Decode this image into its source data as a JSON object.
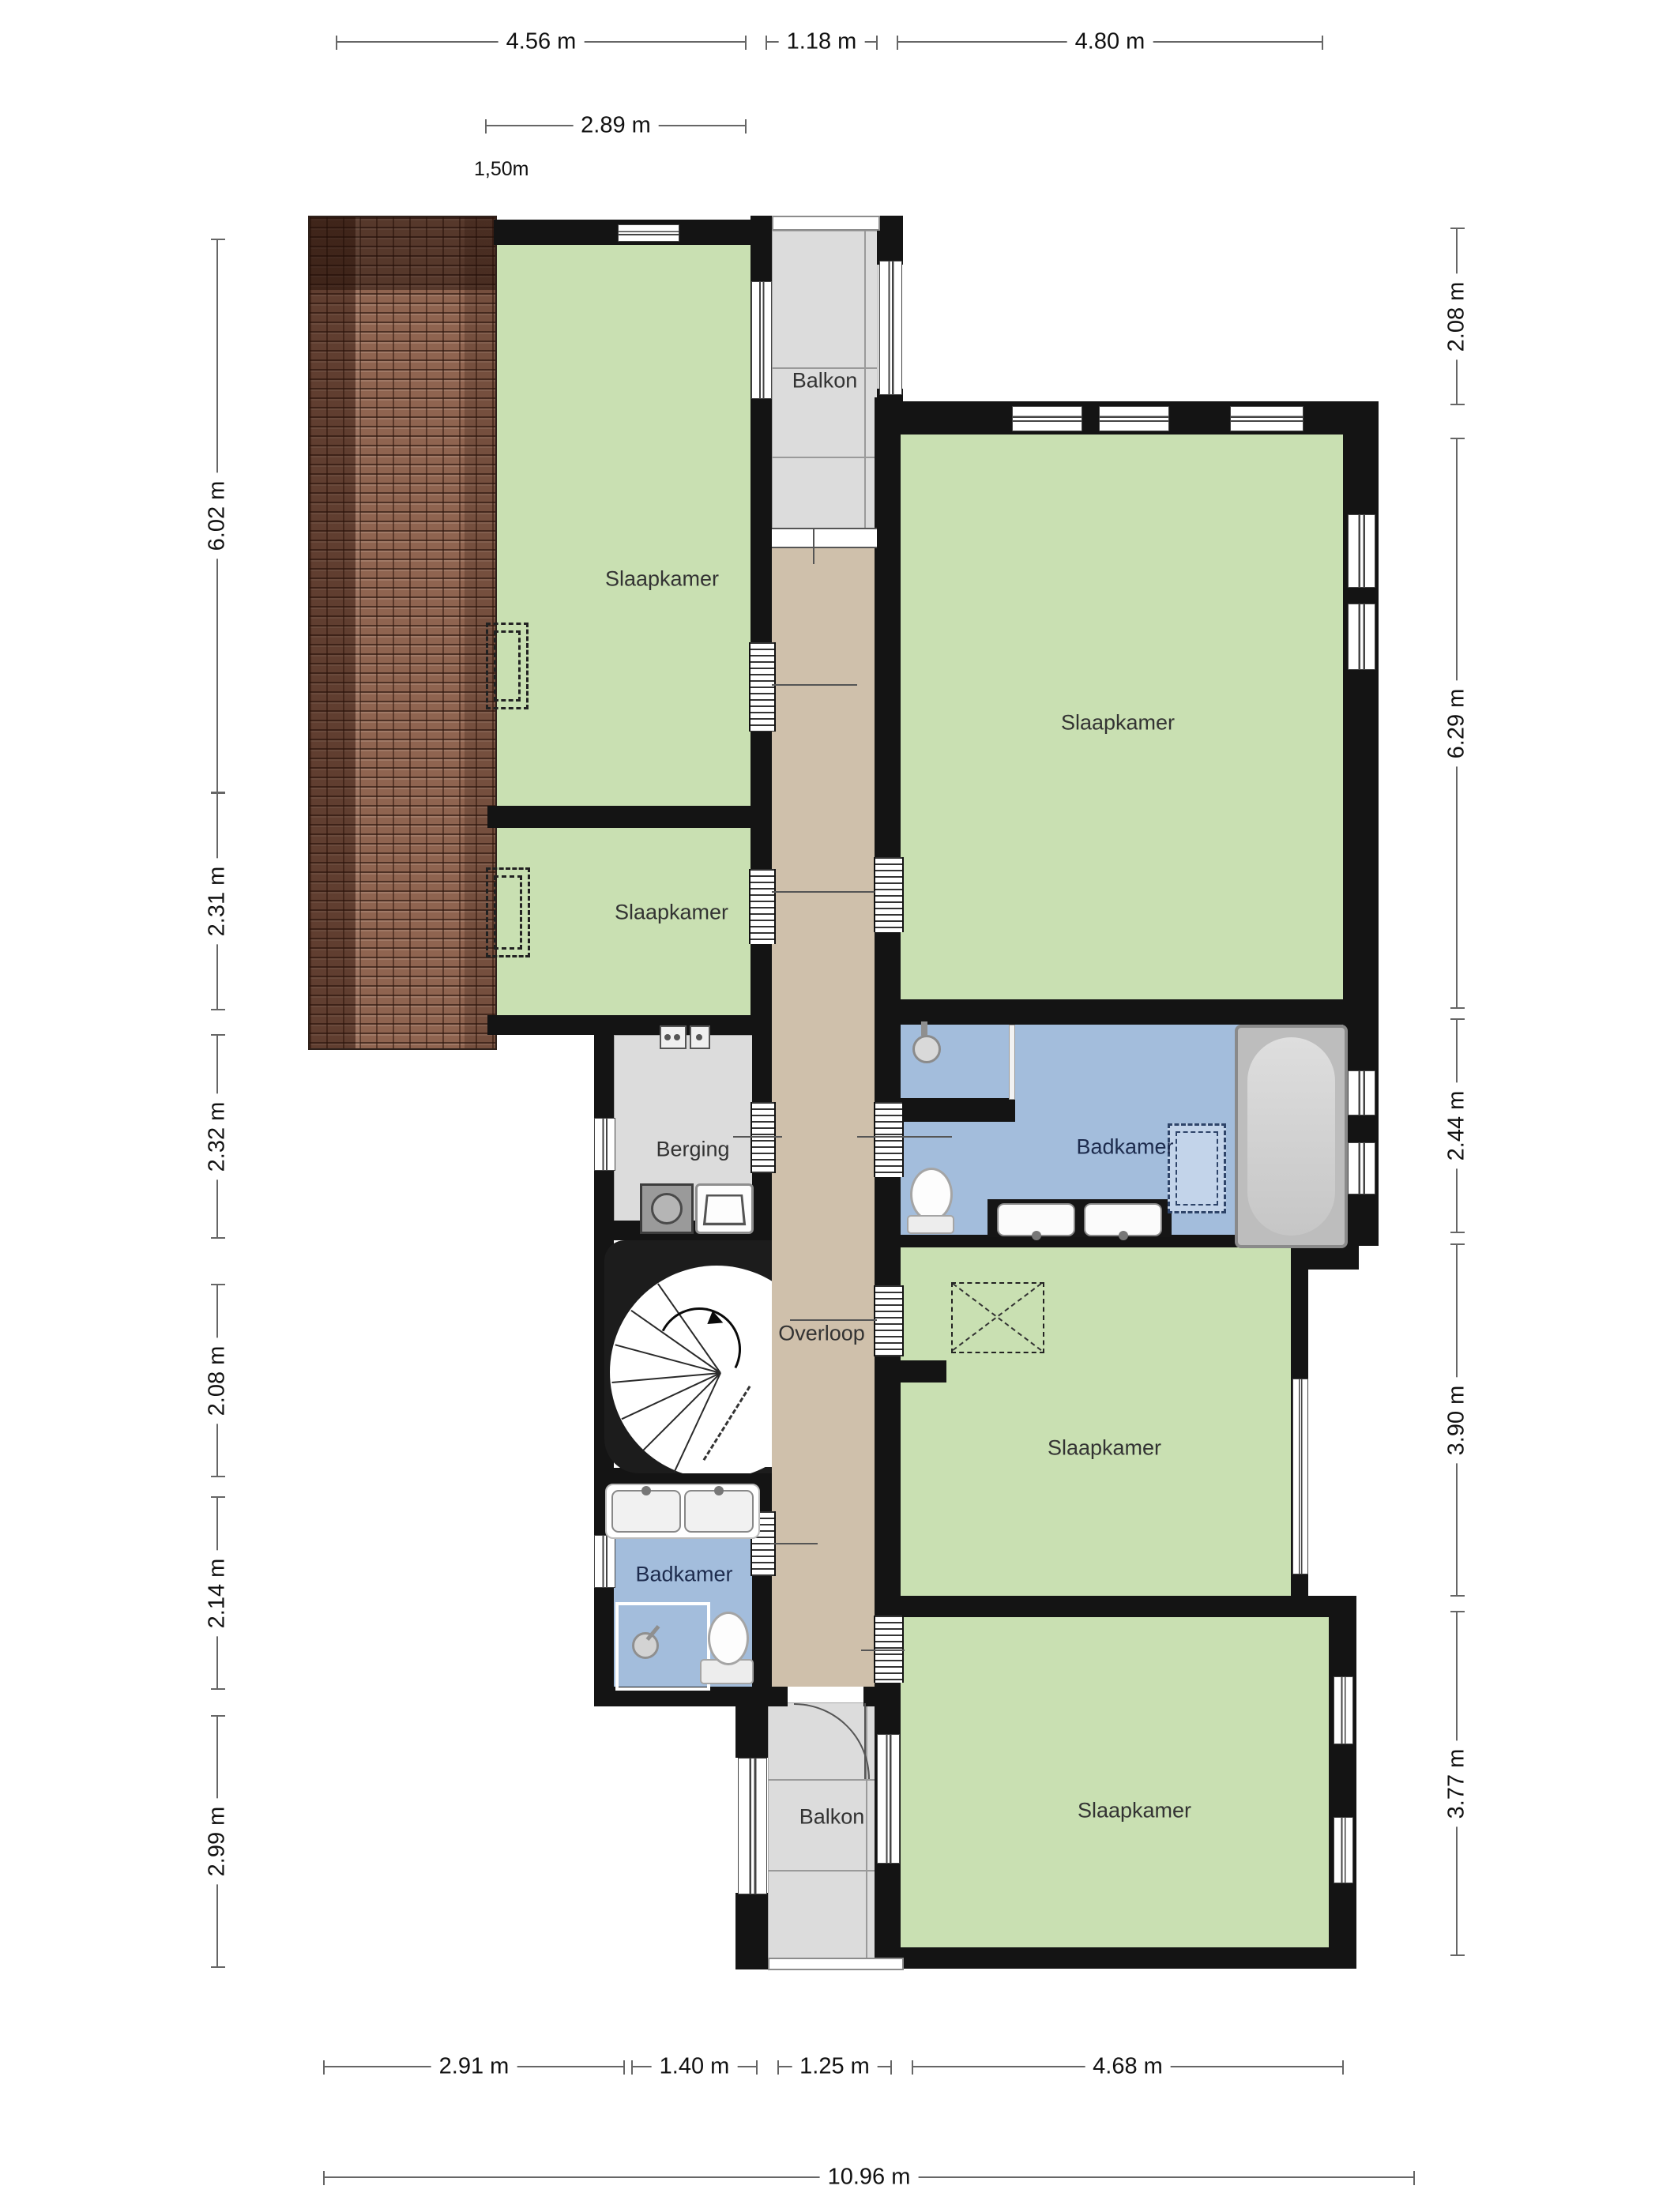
{
  "rooms": {
    "bedroom_top_left": {
      "label": "Slaapkamer"
    },
    "bedroom_top_right": {
      "label": "Slaapkamer"
    },
    "bedroom_mid_left": {
      "label": "Slaapkamer"
    },
    "bedroom_mid_right": {
      "label": "Slaapkamer"
    },
    "bedroom_bottom": {
      "label": "Slaapkamer"
    },
    "balcony_top": {
      "label": "Balkon"
    },
    "balcony_bottom": {
      "label": "Balkon"
    },
    "storage": {
      "label": "Berging"
    },
    "bathroom_right": {
      "label": "Badkamer"
    },
    "bathroom_left": {
      "label": "Badkamer"
    },
    "landing": {
      "label": "Overloop"
    }
  },
  "dimensions": {
    "top": [
      {
        "label": "4.56 m"
      },
      {
        "label": "1.18 m"
      },
      {
        "label": "4.80 m"
      }
    ],
    "top_secondary": [
      {
        "label": "2.89 m"
      }
    ],
    "annotation": {
      "label": "1,50m"
    },
    "left": [
      {
        "label": "6.02 m"
      },
      {
        "label": "2.31 m"
      },
      {
        "label": "2.32 m"
      },
      {
        "label": "2.08 m"
      },
      {
        "label": "2.14 m"
      },
      {
        "label": "2.99 m"
      }
    ],
    "right": [
      {
        "label": "2.08 m"
      },
      {
        "label": "6.29 m"
      },
      {
        "label": "2.44 m"
      },
      {
        "label": "3.90 m"
      },
      {
        "label": "3.77 m"
      }
    ],
    "bottom": [
      {
        "label": "2.91 m"
      },
      {
        "label": "1.40 m"
      },
      {
        "label": "1.25 m"
      },
      {
        "label": "4.68 m"
      }
    ],
    "bottom_total": [
      {
        "label": "10.96 m"
      }
    ]
  },
  "colors": {
    "bedroom_floor": "#c9e0b2",
    "bathroom_floor": "#a3bddc",
    "hallway_floor": "#cfc0ab",
    "balcony_floor": "#dcdcdc",
    "wall": "#141414",
    "roof_tiles": "#8f6450"
  }
}
